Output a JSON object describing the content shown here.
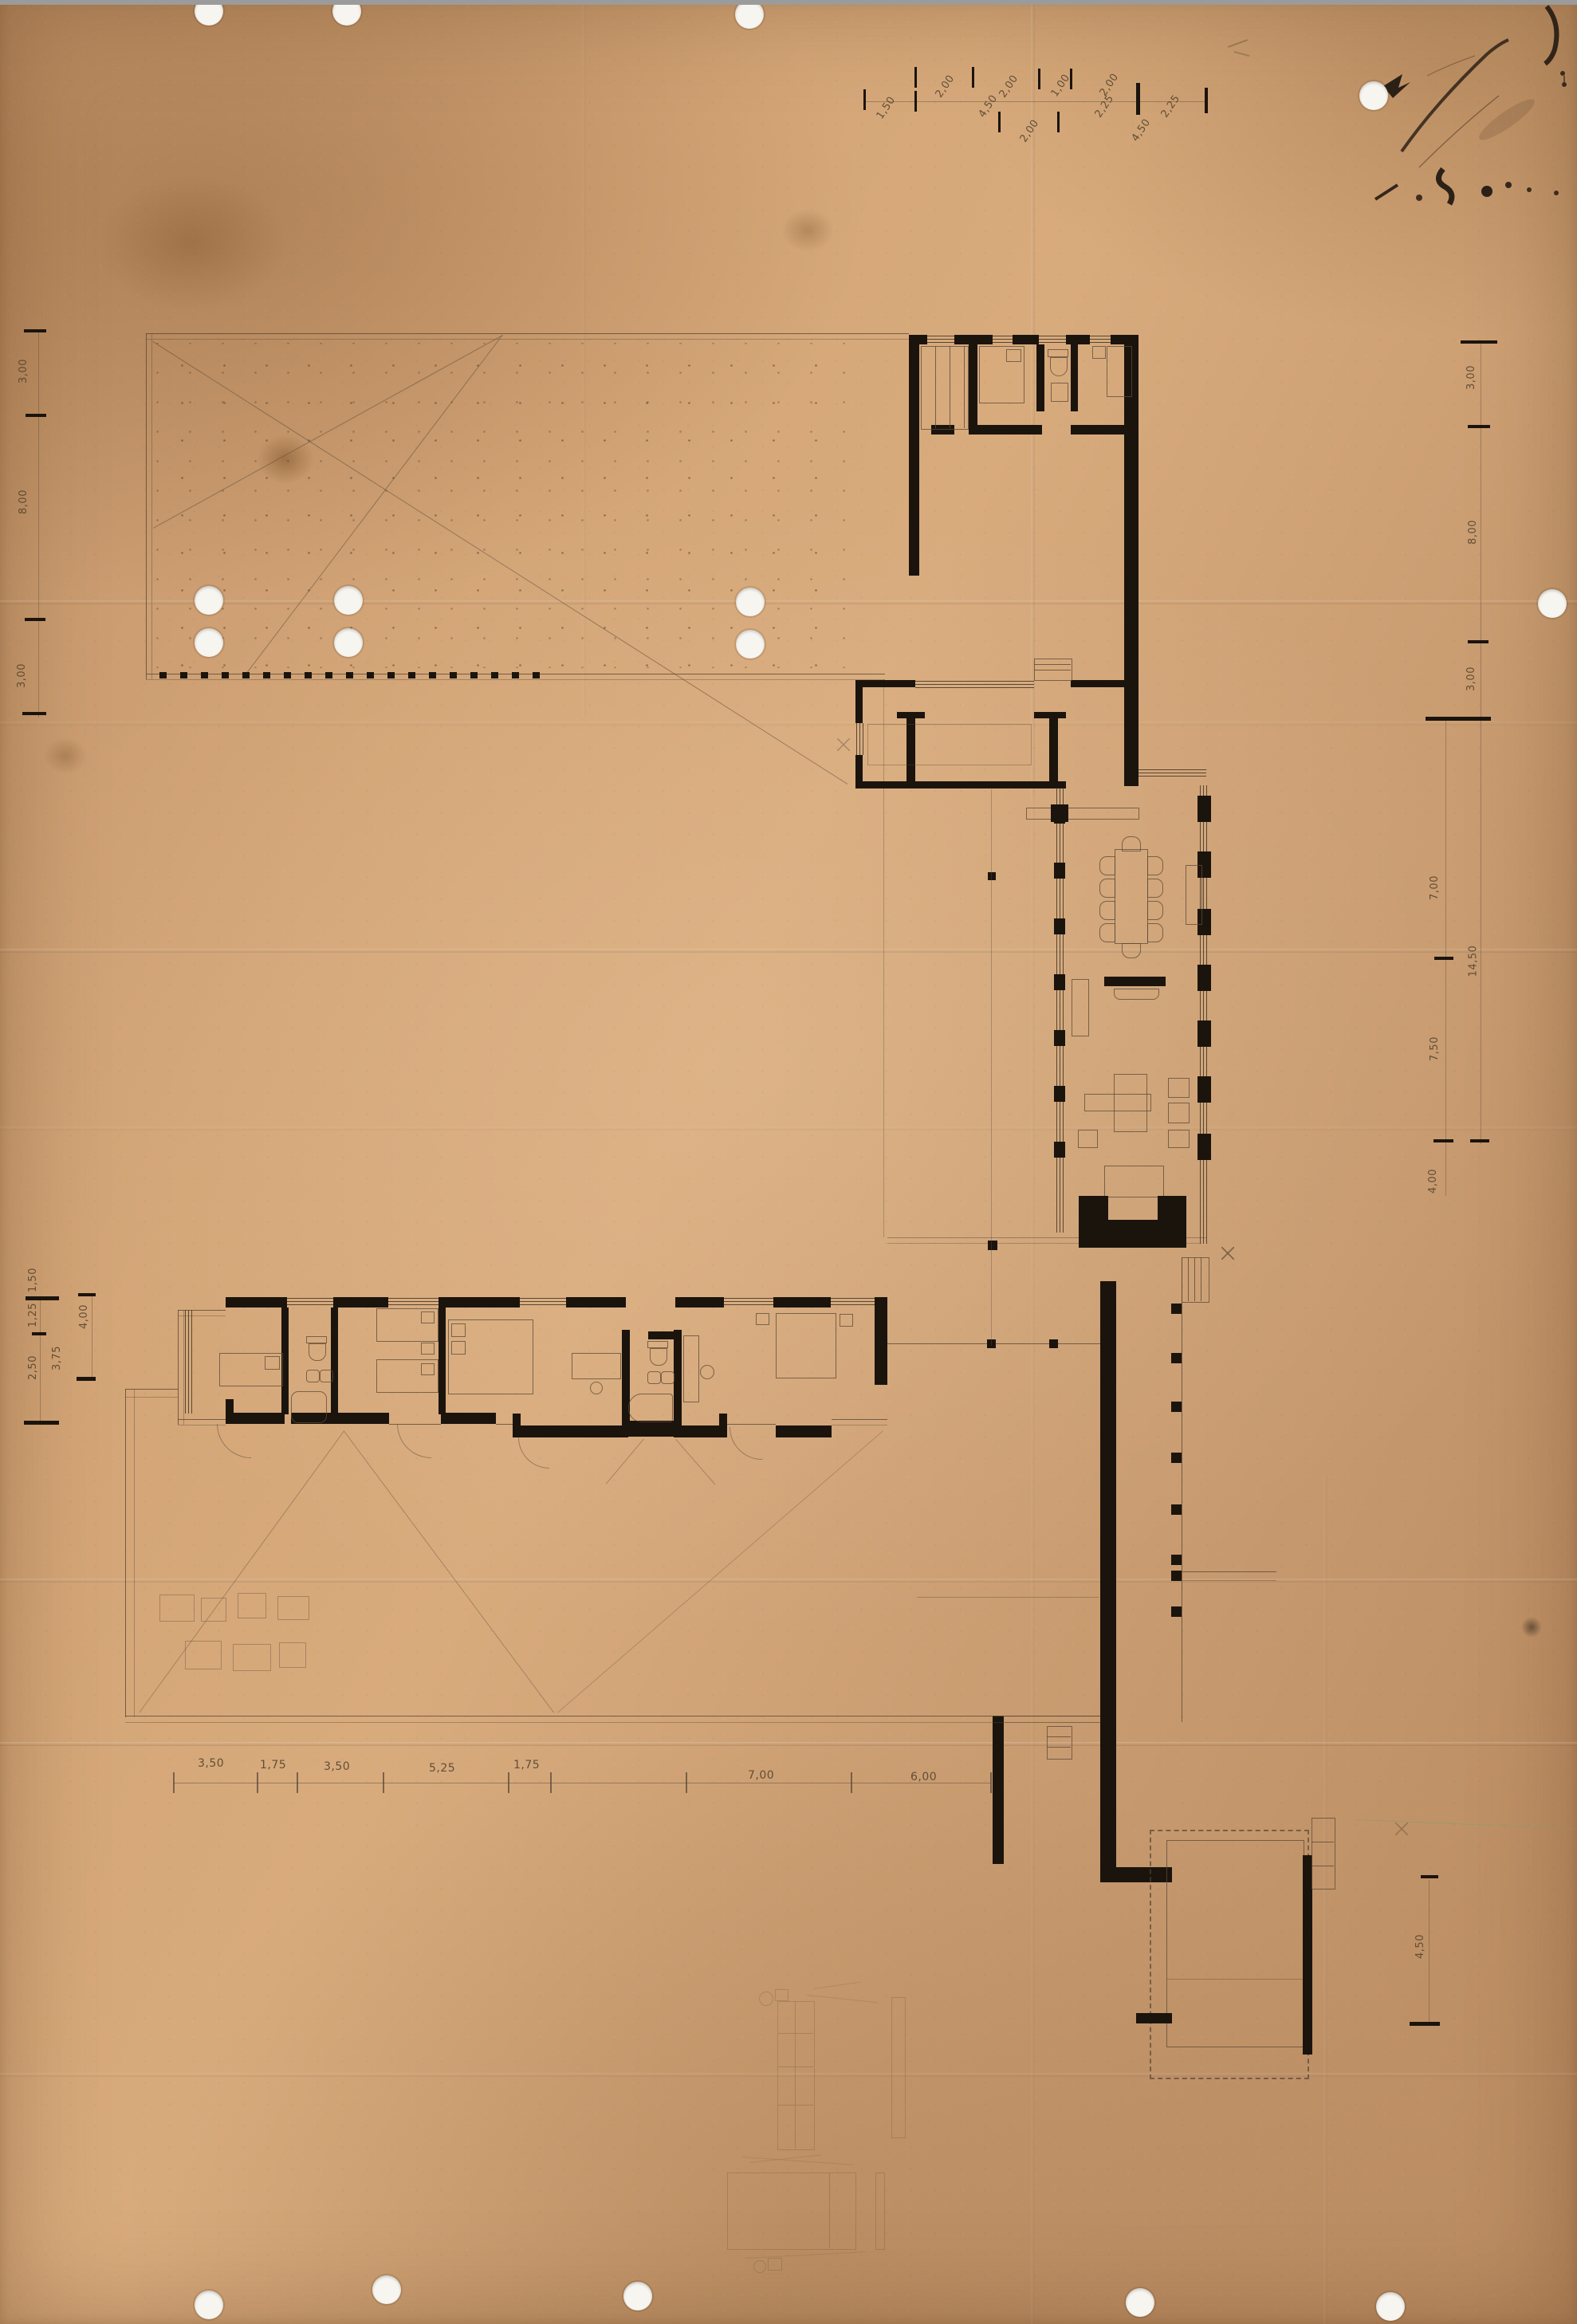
{
  "colors": {
    "paper": "#cf9e71",
    "paper_light": "#dcb183",
    "paper_dark": "#b1834f",
    "ink": "#1b140d",
    "pencil": "#5a4a38",
    "punch_hole": "#f7f5f0",
    "scanner_edge": "#9b9b9b",
    "green_accent": "#7f9e6d"
  },
  "dims": {
    "top": [
      "1,50",
      "2,00",
      "4,50",
      "2,00",
      "2,00",
      "1,00",
      "2,25",
      "2,00",
      "4,50",
      "2,25"
    ],
    "left_upper": [
      "3,00",
      "8,00",
      "3,00"
    ],
    "left_lower": [
      "1,50",
      "1,25",
      "2,50",
      "3,75",
      "4,00"
    ],
    "right_upper": [
      "3,00",
      "8,00",
      "3,00"
    ],
    "right_lower": [
      "7,00",
      "14,50",
      "7,50",
      "4,00",
      "4,50"
    ],
    "bottom": [
      "3,50",
      "1,75",
      "3,50",
      "5,25",
      "1,75",
      "7,00",
      "6,00"
    ]
  }
}
